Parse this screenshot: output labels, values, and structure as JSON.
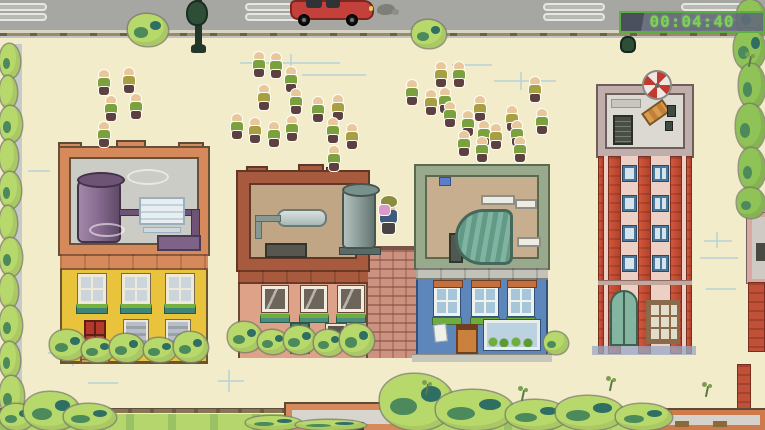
{
  "hud": {
    "timer": "00:04:40"
  },
  "palette": {
    "ground": "#f3ecca",
    "road": "#a6a6a2",
    "roadDash": "#b8b8b4",
    "roadDashEdge": "#e7e7e1",
    "sidewalk": "#d9d5c5",
    "curb": "#9b8a66",
    "curbDot": "#6f5f43",
    "grass": "#b5d66d",
    "fence": "#8a7456",
    "bushLight": "#b7d86b",
    "treeGreen": "#8fc257",
    "leafDark": "#4c8a5c",
    "leafTeal": "#2f6e62",
    "shadowBlue": "#9aaac4",
    "sketch": "#b5d2d6",
    "skin": "#e9c79c",
    "shirtGreen": "#7ba03e",
    "shirtOlive": "#a89f45",
    "pants": "#5d4040",
    "outlineWhite": "#fdfdf5",
    "playerCap": "#8a8c3e",
    "playerItem": "#dc98c9",
    "playerShirt": "#3f5a7d",
    "playerPants": "#4a4343",
    "carRed": "#c4403a",
    "carDark": "#7c2620",
    "lampGreen": "#2e4f37",
    "yellowFacade": "#e9c33c",
    "yellowTrim": "#6a5530",
    "roofGray": "#ccccc6",
    "roofSalmon": "#d68a5c",
    "tankPurple": "#8a6d92",
    "pinkFacade": "#dda287",
    "pinkBrick": "#a85a3e",
    "pinkRoof": "#c0a685",
    "tankGray": "#8fa09d",
    "blueFacade": "#5d87bb",
    "blueRoofBorder": "#99a98c",
    "blueRoofFloor": "#c6ae8e",
    "atriumTeal": "#7fb3a2",
    "towerPanel": "#eccfc5",
    "towerRoofBorder": "#bfaeac",
    "towerWinBlue": "#49789c",
    "timerBorder": "#5fae43",
    "timerText": "#7ed157",
    "brickWall": "#cc917f"
  },
  "road": {
    "dash_xs": [
      -15,
      245,
      543,
      681
    ],
    "dash_rows": [
      3,
      13
    ]
  },
  "player": {
    "x": 378,
    "y": 196
  },
  "crowd": {
    "members": [
      {
        "x": 97,
        "y": 70,
        "shirt": "green"
      },
      {
        "x": 122,
        "y": 68,
        "shirt": "olive"
      },
      {
        "x": 104,
        "y": 96,
        "shirt": "green"
      },
      {
        "x": 129,
        "y": 94,
        "shirt": "green"
      },
      {
        "x": 97,
        "y": 122,
        "shirt": "green"
      },
      {
        "x": 252,
        "y": 52,
        "shirt": "green"
      },
      {
        "x": 269,
        "y": 53,
        "shirt": "green"
      },
      {
        "x": 284,
        "y": 67,
        "shirt": "green"
      },
      {
        "x": 257,
        "y": 85,
        "shirt": "olive"
      },
      {
        "x": 289,
        "y": 89,
        "shirt": "green"
      },
      {
        "x": 311,
        "y": 97,
        "shirt": "green"
      },
      {
        "x": 331,
        "y": 95,
        "shirt": "olive"
      },
      {
        "x": 230,
        "y": 114,
        "shirt": "green"
      },
      {
        "x": 248,
        "y": 118,
        "shirt": "olive"
      },
      {
        "x": 267,
        "y": 122,
        "shirt": "green"
      },
      {
        "x": 285,
        "y": 116,
        "shirt": "green"
      },
      {
        "x": 326,
        "y": 118,
        "shirt": "green"
      },
      {
        "x": 345,
        "y": 124,
        "shirt": "olive"
      },
      {
        "x": 327,
        "y": 146,
        "shirt": "green"
      },
      {
        "x": 405,
        "y": 80,
        "shirt": "green"
      },
      {
        "x": 424,
        "y": 90,
        "shirt": "olive"
      },
      {
        "x": 434,
        "y": 62,
        "shirt": "olive"
      },
      {
        "x": 452,
        "y": 62,
        "shirt": "green"
      },
      {
        "x": 438,
        "y": 88,
        "shirt": "green"
      },
      {
        "x": 443,
        "y": 102,
        "shirt": "green"
      },
      {
        "x": 461,
        "y": 111,
        "shirt": "green"
      },
      {
        "x": 473,
        "y": 96,
        "shirt": "olive"
      },
      {
        "x": 477,
        "y": 121,
        "shirt": "green"
      },
      {
        "x": 457,
        "y": 131,
        "shirt": "green"
      },
      {
        "x": 475,
        "y": 137,
        "shirt": "green"
      },
      {
        "x": 489,
        "y": 124,
        "shirt": "olive"
      },
      {
        "x": 505,
        "y": 106,
        "shirt": "olive"
      },
      {
        "x": 510,
        "y": 121,
        "shirt": "green"
      },
      {
        "x": 513,
        "y": 137,
        "shirt": "green"
      },
      {
        "x": 528,
        "y": 77,
        "shirt": "olive"
      },
      {
        "x": 535,
        "y": 109,
        "shirt": "green"
      }
    ]
  },
  "foliage": [
    {
      "t": "bush",
      "x": 0,
      "y": 44,
      "w": 20,
      "h": 34
    },
    {
      "t": "bush",
      "x": 0,
      "y": 76,
      "w": 17,
      "h": 32
    },
    {
      "t": "bush",
      "x": 0,
      "y": 106,
      "w": 22,
      "h": 36
    },
    {
      "t": "bush",
      "x": 0,
      "y": 140,
      "w": 18,
      "h": 34
    },
    {
      "t": "bush",
      "x": 0,
      "y": 172,
      "w": 21,
      "h": 36
    },
    {
      "t": "bush",
      "x": 0,
      "y": 206,
      "w": 17,
      "h": 34
    },
    {
      "t": "bush",
      "x": 0,
      "y": 238,
      "w": 22,
      "h": 38
    },
    {
      "t": "bush",
      "x": 0,
      "y": 274,
      "w": 18,
      "h": 34
    },
    {
      "t": "bush",
      "x": 0,
      "y": 306,
      "w": 22,
      "h": 38
    },
    {
      "t": "bush",
      "x": 0,
      "y": 342,
      "w": 20,
      "h": 36
    },
    {
      "t": "bush",
      "x": 0,
      "y": 376,
      "w": 24,
      "h": 40
    },
    {
      "t": "bush",
      "x": 0,
      "y": 404,
      "w": 34,
      "h": 26
    },
    {
      "t": "bush",
      "x": 128,
      "y": 14,
      "w": 40,
      "h": 32
    },
    {
      "t": "bush",
      "x": 412,
      "y": 20,
      "w": 34,
      "h": 28
    },
    {
      "t": "tree",
      "x": 737,
      "y": 0,
      "w": 28,
      "h": 34
    },
    {
      "t": "tree",
      "x": 734,
      "y": 28,
      "w": 31,
      "h": 42
    },
    {
      "t": "tree",
      "x": 739,
      "y": 64,
      "w": 26,
      "h": 44
    },
    {
      "t": "tree",
      "x": 736,
      "y": 104,
      "w": 29,
      "h": 46
    },
    {
      "t": "tree",
      "x": 739,
      "y": 148,
      "w": 26,
      "h": 42
    },
    {
      "t": "tree",
      "x": 737,
      "y": 188,
      "w": 28,
      "h": 30
    },
    {
      "t": "bush",
      "x": 24,
      "y": 392,
      "w": 56,
      "h": 38
    },
    {
      "t": "bush",
      "x": 64,
      "y": 404,
      "w": 52,
      "h": 26
    },
    {
      "t": "bush",
      "x": 380,
      "y": 374,
      "w": 74,
      "h": 56
    },
    {
      "t": "bush",
      "x": 436,
      "y": 390,
      "w": 78,
      "h": 40
    },
    {
      "t": "bush",
      "x": 506,
      "y": 400,
      "w": 62,
      "h": 30
    },
    {
      "t": "bush",
      "x": 556,
      "y": 396,
      "w": 68,
      "h": 34
    },
    {
      "t": "bush",
      "x": 616,
      "y": 404,
      "w": 56,
      "h": 26
    },
    {
      "t": "bush",
      "x": 246,
      "y": 416,
      "w": 56,
      "h": 14
    },
    {
      "t": "bush",
      "x": 296,
      "y": 420,
      "w": 70,
      "h": 10
    },
    {
      "t": "bush",
      "x": 50,
      "y": 330,
      "w": 36,
      "h": 30
    },
    {
      "t": "bush",
      "x": 82,
      "y": 338,
      "w": 32,
      "h": 24
    },
    {
      "t": "bush",
      "x": 110,
      "y": 334,
      "w": 34,
      "h": 28
    },
    {
      "t": "bush",
      "x": 144,
      "y": 338,
      "w": 32,
      "h": 24
    },
    {
      "t": "bush",
      "x": 174,
      "y": 332,
      "w": 34,
      "h": 30
    },
    {
      "t": "bush",
      "x": 228,
      "y": 322,
      "w": 34,
      "h": 30
    },
    {
      "t": "bush",
      "x": 258,
      "y": 330,
      "w": 30,
      "h": 24
    },
    {
      "t": "bush",
      "x": 284,
      "y": 326,
      "w": 32,
      "h": 28
    },
    {
      "t": "bush",
      "x": 314,
      "y": 330,
      "w": 30,
      "h": 26
    },
    {
      "t": "bush",
      "x": 340,
      "y": 324,
      "w": 34,
      "h": 32
    },
    {
      "t": "bush",
      "x": 544,
      "y": 332,
      "w": 24,
      "h": 22
    },
    {
      "t": "sprig",
      "x": 421,
      "y": 380
    },
    {
      "t": "sprig",
      "x": 517,
      "y": 386
    },
    {
      "t": "sprig",
      "x": 605,
      "y": 376
    },
    {
      "t": "sprig",
      "x": 701,
      "y": 382
    },
    {
      "t": "sprig",
      "x": 744,
      "y": 52
    }
  ],
  "sketch_marks": [
    {
      "x": 240,
      "y": 62,
      "w": 100,
      "h": 2
    },
    {
      "x": 290,
      "y": 54,
      "w": 2,
      "h": 16
    },
    {
      "x": 302,
      "y": 74,
      "w": 64,
      "h": 2
    },
    {
      "x": 494,
      "y": 80,
      "w": 62,
      "h": 2
    },
    {
      "x": 520,
      "y": 72,
      "w": 2,
      "h": 18
    },
    {
      "x": 452,
      "y": 64,
      "w": 40,
      "h": 2
    },
    {
      "x": 48,
      "y": 352,
      "w": 52,
      "h": 2
    },
    {
      "x": 72,
      "y": 340,
      "w": 2,
      "h": 26
    },
    {
      "x": 28,
      "y": 170,
      "w": 22,
      "h": 2
    },
    {
      "x": 704,
      "y": 240,
      "w": 28,
      "h": 2
    },
    {
      "x": 700,
      "y": 257,
      "w": 38,
      "h": 2
    },
    {
      "x": 706,
      "y": 288,
      "w": 30,
      "h": 2
    },
    {
      "x": 716,
      "y": 232,
      "w": 2,
      "h": 16
    },
    {
      "x": 218,
      "y": 380,
      "w": 26,
      "h": 2
    },
    {
      "x": 228,
      "y": 370,
      "w": 2,
      "h": 22
    },
    {
      "x": 88,
      "y": 382,
      "w": 30,
      "h": 2
    },
    {
      "x": 628,
      "y": 142,
      "w": 30,
      "h": 2
    },
    {
      "x": 120,
      "y": 246,
      "w": 26,
      "h": 2
    }
  ]
}
